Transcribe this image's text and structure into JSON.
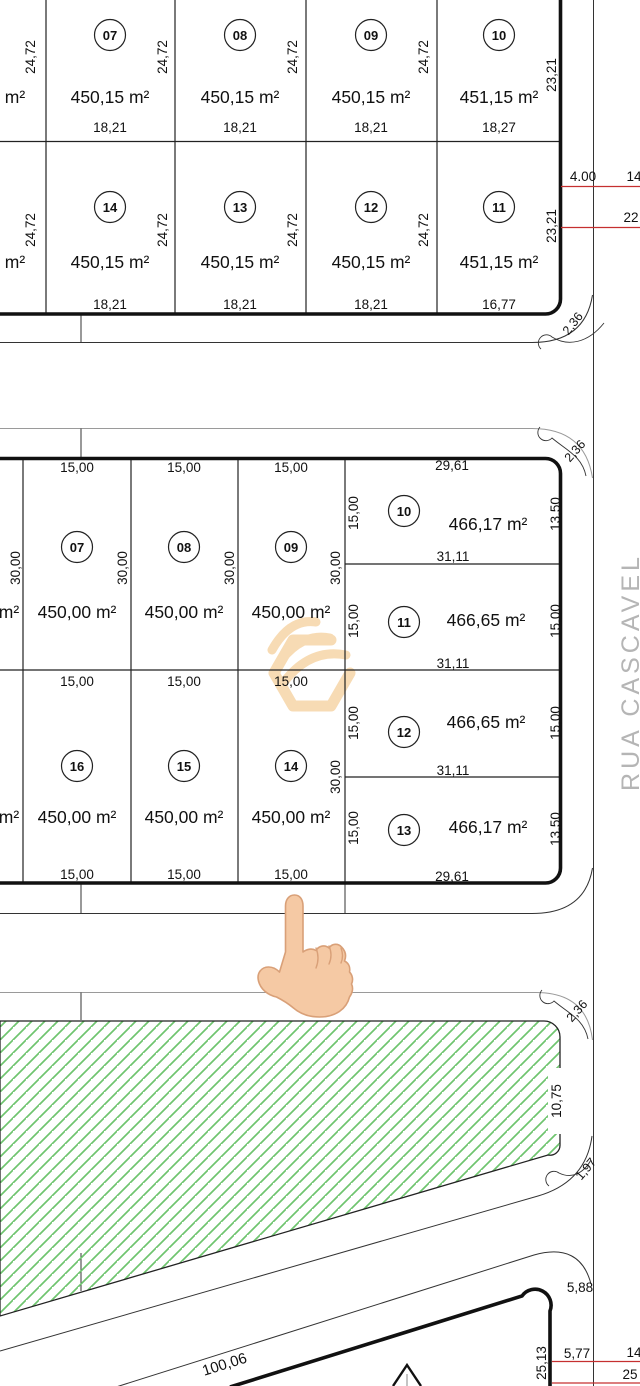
{
  "street": {
    "name": "RUA CASCAVEL"
  },
  "block_a": {
    "row1": {
      "cut": {
        "side": "24,72",
        "area": "m²"
      },
      "lots": [
        {
          "num": "07",
          "side": "24,72",
          "area": "450,15 m²",
          "front": "18,21"
        },
        {
          "num": "08",
          "side": "24,72",
          "area": "450,15 m²",
          "front": "18,21"
        },
        {
          "num": "09",
          "side": "24,72",
          "area": "450,15 m²",
          "front": "18,21"
        },
        {
          "num": "10",
          "area": "451,15 m²",
          "front": "18,27",
          "side_right": "23,21"
        }
      ]
    },
    "row2": {
      "cut": {
        "side": "24,72",
        "area": "m²"
      },
      "lots": [
        {
          "num": "14",
          "side": "24,72",
          "area": "450,15 m²",
          "front": "18,21"
        },
        {
          "num": "13",
          "side": "24,72",
          "area": "450,15 m²",
          "front": "18,21"
        },
        {
          "num": "12",
          "side": "24,72",
          "area": "450,15 m²",
          "front": "18,21"
        },
        {
          "num": "11",
          "area": "451,15 m²",
          "front": "16,77",
          "side_right": "23,21"
        }
      ]
    },
    "red_dims": [
      "4.00",
      "14",
      "22"
    ],
    "corner": "2,36"
  },
  "block_b": {
    "row1": {
      "cut_area": "m²",
      "cut_side": "30,00",
      "top_dims": [
        "15,00",
        "15,00",
        "15,00"
      ],
      "lots": [
        {
          "num": "07",
          "area": "450,00 m²",
          "side": "30,00"
        },
        {
          "num": "08",
          "area": "450,00 m²",
          "side": "30,00"
        },
        {
          "num": "09",
          "area": "450,00 m²",
          "side": "30,00"
        }
      ]
    },
    "row2": {
      "cut_area": "m²",
      "top_dims": [
        "15,00",
        "15,00",
        "15,00"
      ],
      "bottom_dims": [
        "15,00",
        "15,00",
        "15,00"
      ],
      "lots": [
        {
          "num": "16",
          "area": "450,00 m²"
        },
        {
          "num": "15",
          "area": "450,00 m²"
        },
        {
          "num": "14",
          "area": "450,00 m²",
          "side": "30,00"
        }
      ]
    },
    "right_lots": [
      {
        "num": "10",
        "area": "466,17 m²",
        "top": "29,61",
        "left": "15,00",
        "right": "13,50",
        "bottom": "31,11"
      },
      {
        "num": "11",
        "area": "466,65 m²",
        "left": "15,00",
        "right": "15,00",
        "bottom": "31,11"
      },
      {
        "num": "12",
        "area": "466,65 m²",
        "left": "15,00",
        "right": "15,00",
        "bottom": "31,11"
      },
      {
        "num": "13",
        "area": "466,17 m²",
        "left": "15,00",
        "right": "13,50",
        "bottom": "29,61"
      }
    ],
    "corner": "2,36"
  },
  "green_area": {
    "right_dim": "10,75",
    "corner_top": "2,36",
    "corner_bottom": "1,97"
  },
  "block_c": {
    "edge_dim": "100,06",
    "corner_dim": "5,88",
    "right_dim_outer": "25,13",
    "right_dim_inner": "5,77",
    "red_dims": [
      "14",
      "25"
    ]
  },
  "icons": {
    "pointer": "up-pointing-index-hand"
  },
  "colors": {
    "hatch_green": "#6fc46f",
    "red_dim_line": "#c53030",
    "watermark_orange": "#f6d3a2",
    "street_text": "#b5b5b5"
  }
}
